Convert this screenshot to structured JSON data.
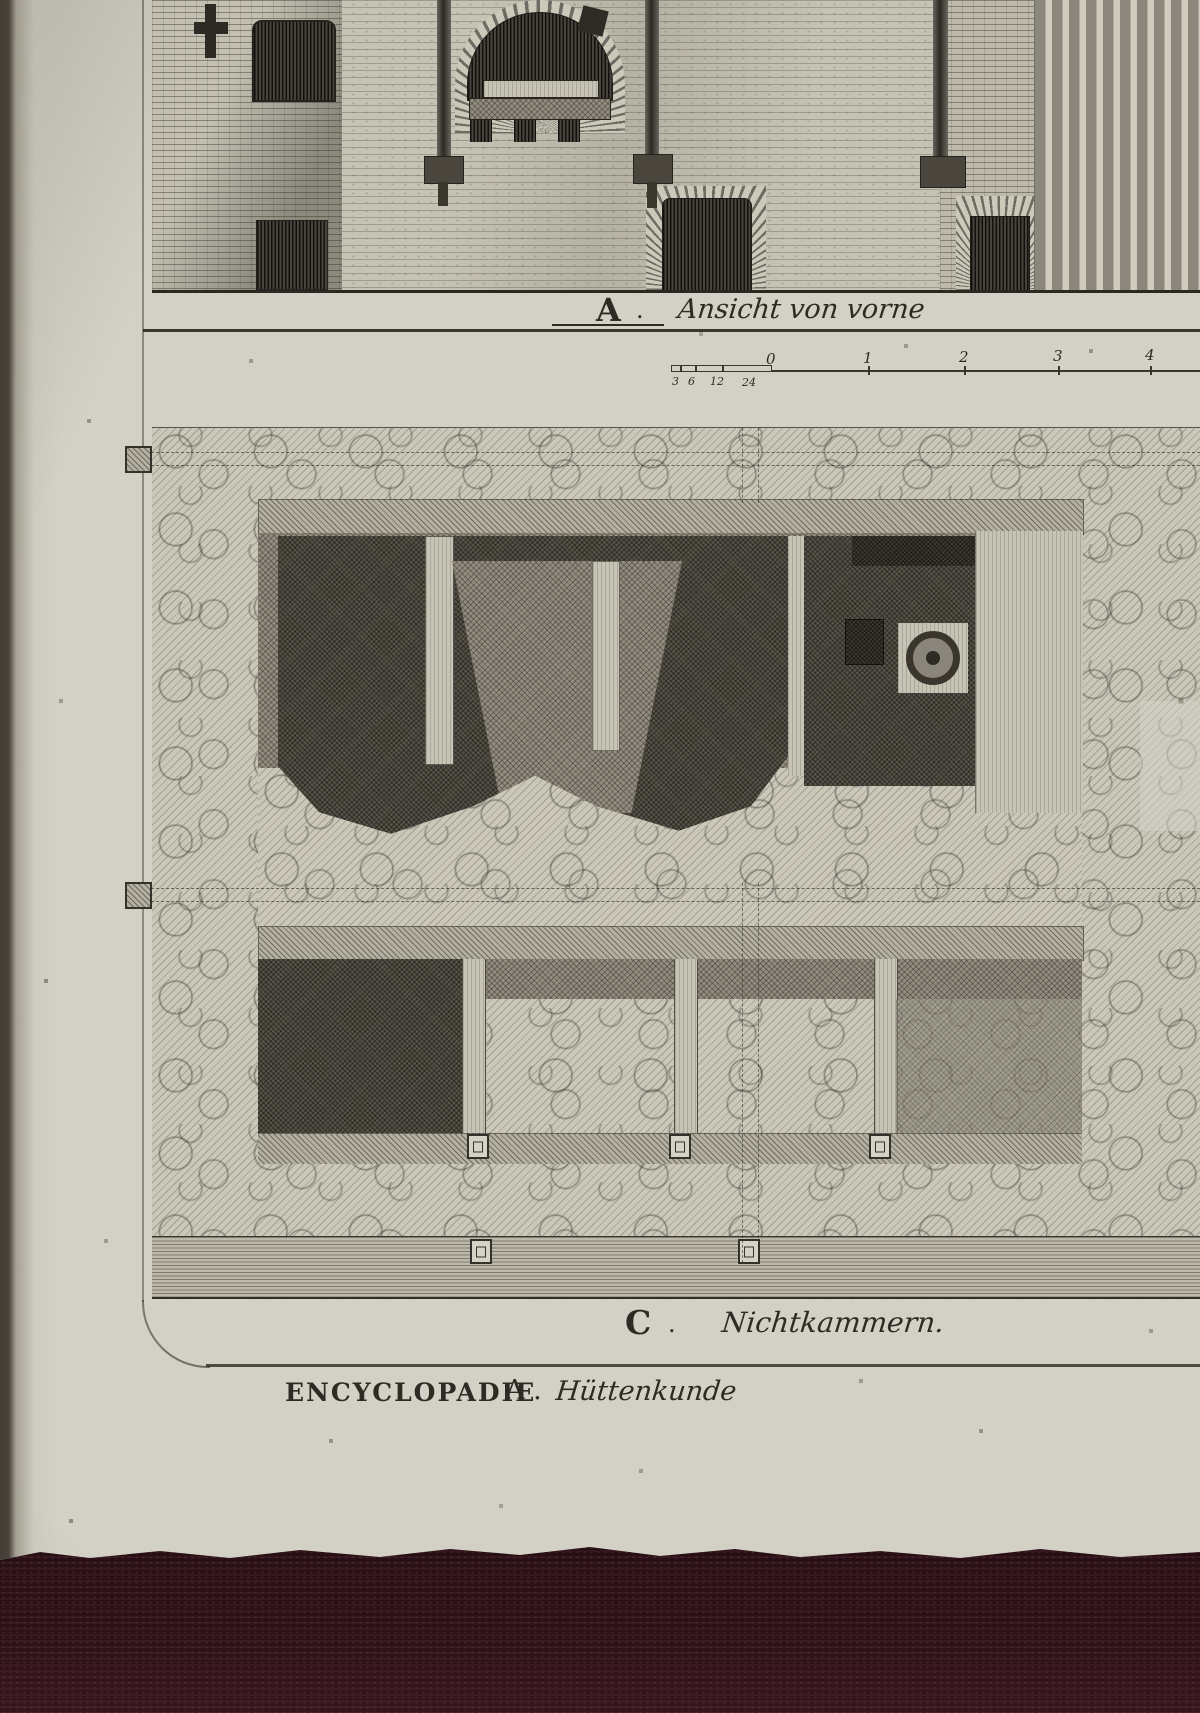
{
  "photo": {
    "scene": "antique engraved encyclopedia plate lying on dark red fabric",
    "colors": {
      "paper": "#d3d1c6",
      "ink": "#2e2b24",
      "fabric": "#2b1117"
    }
  },
  "plate": {
    "view_a": {
      "letter": "A",
      "sep": ".",
      "caption": "Ansicht von vorne"
    },
    "view_c": {
      "letter": "C",
      "sep": ".",
      "caption": "Nichtkammern."
    },
    "scale_bar": {
      "minor_labels": [
        "3",
        "6",
        "12",
        "24"
      ],
      "zero_label": "0",
      "major_labels": [
        "1",
        "2",
        "3",
        "4"
      ]
    },
    "imprint": {
      "title_caps": "ENCYCLOPADIE",
      "letter": "A .",
      "subject": "Hüttenkunde"
    }
  }
}
